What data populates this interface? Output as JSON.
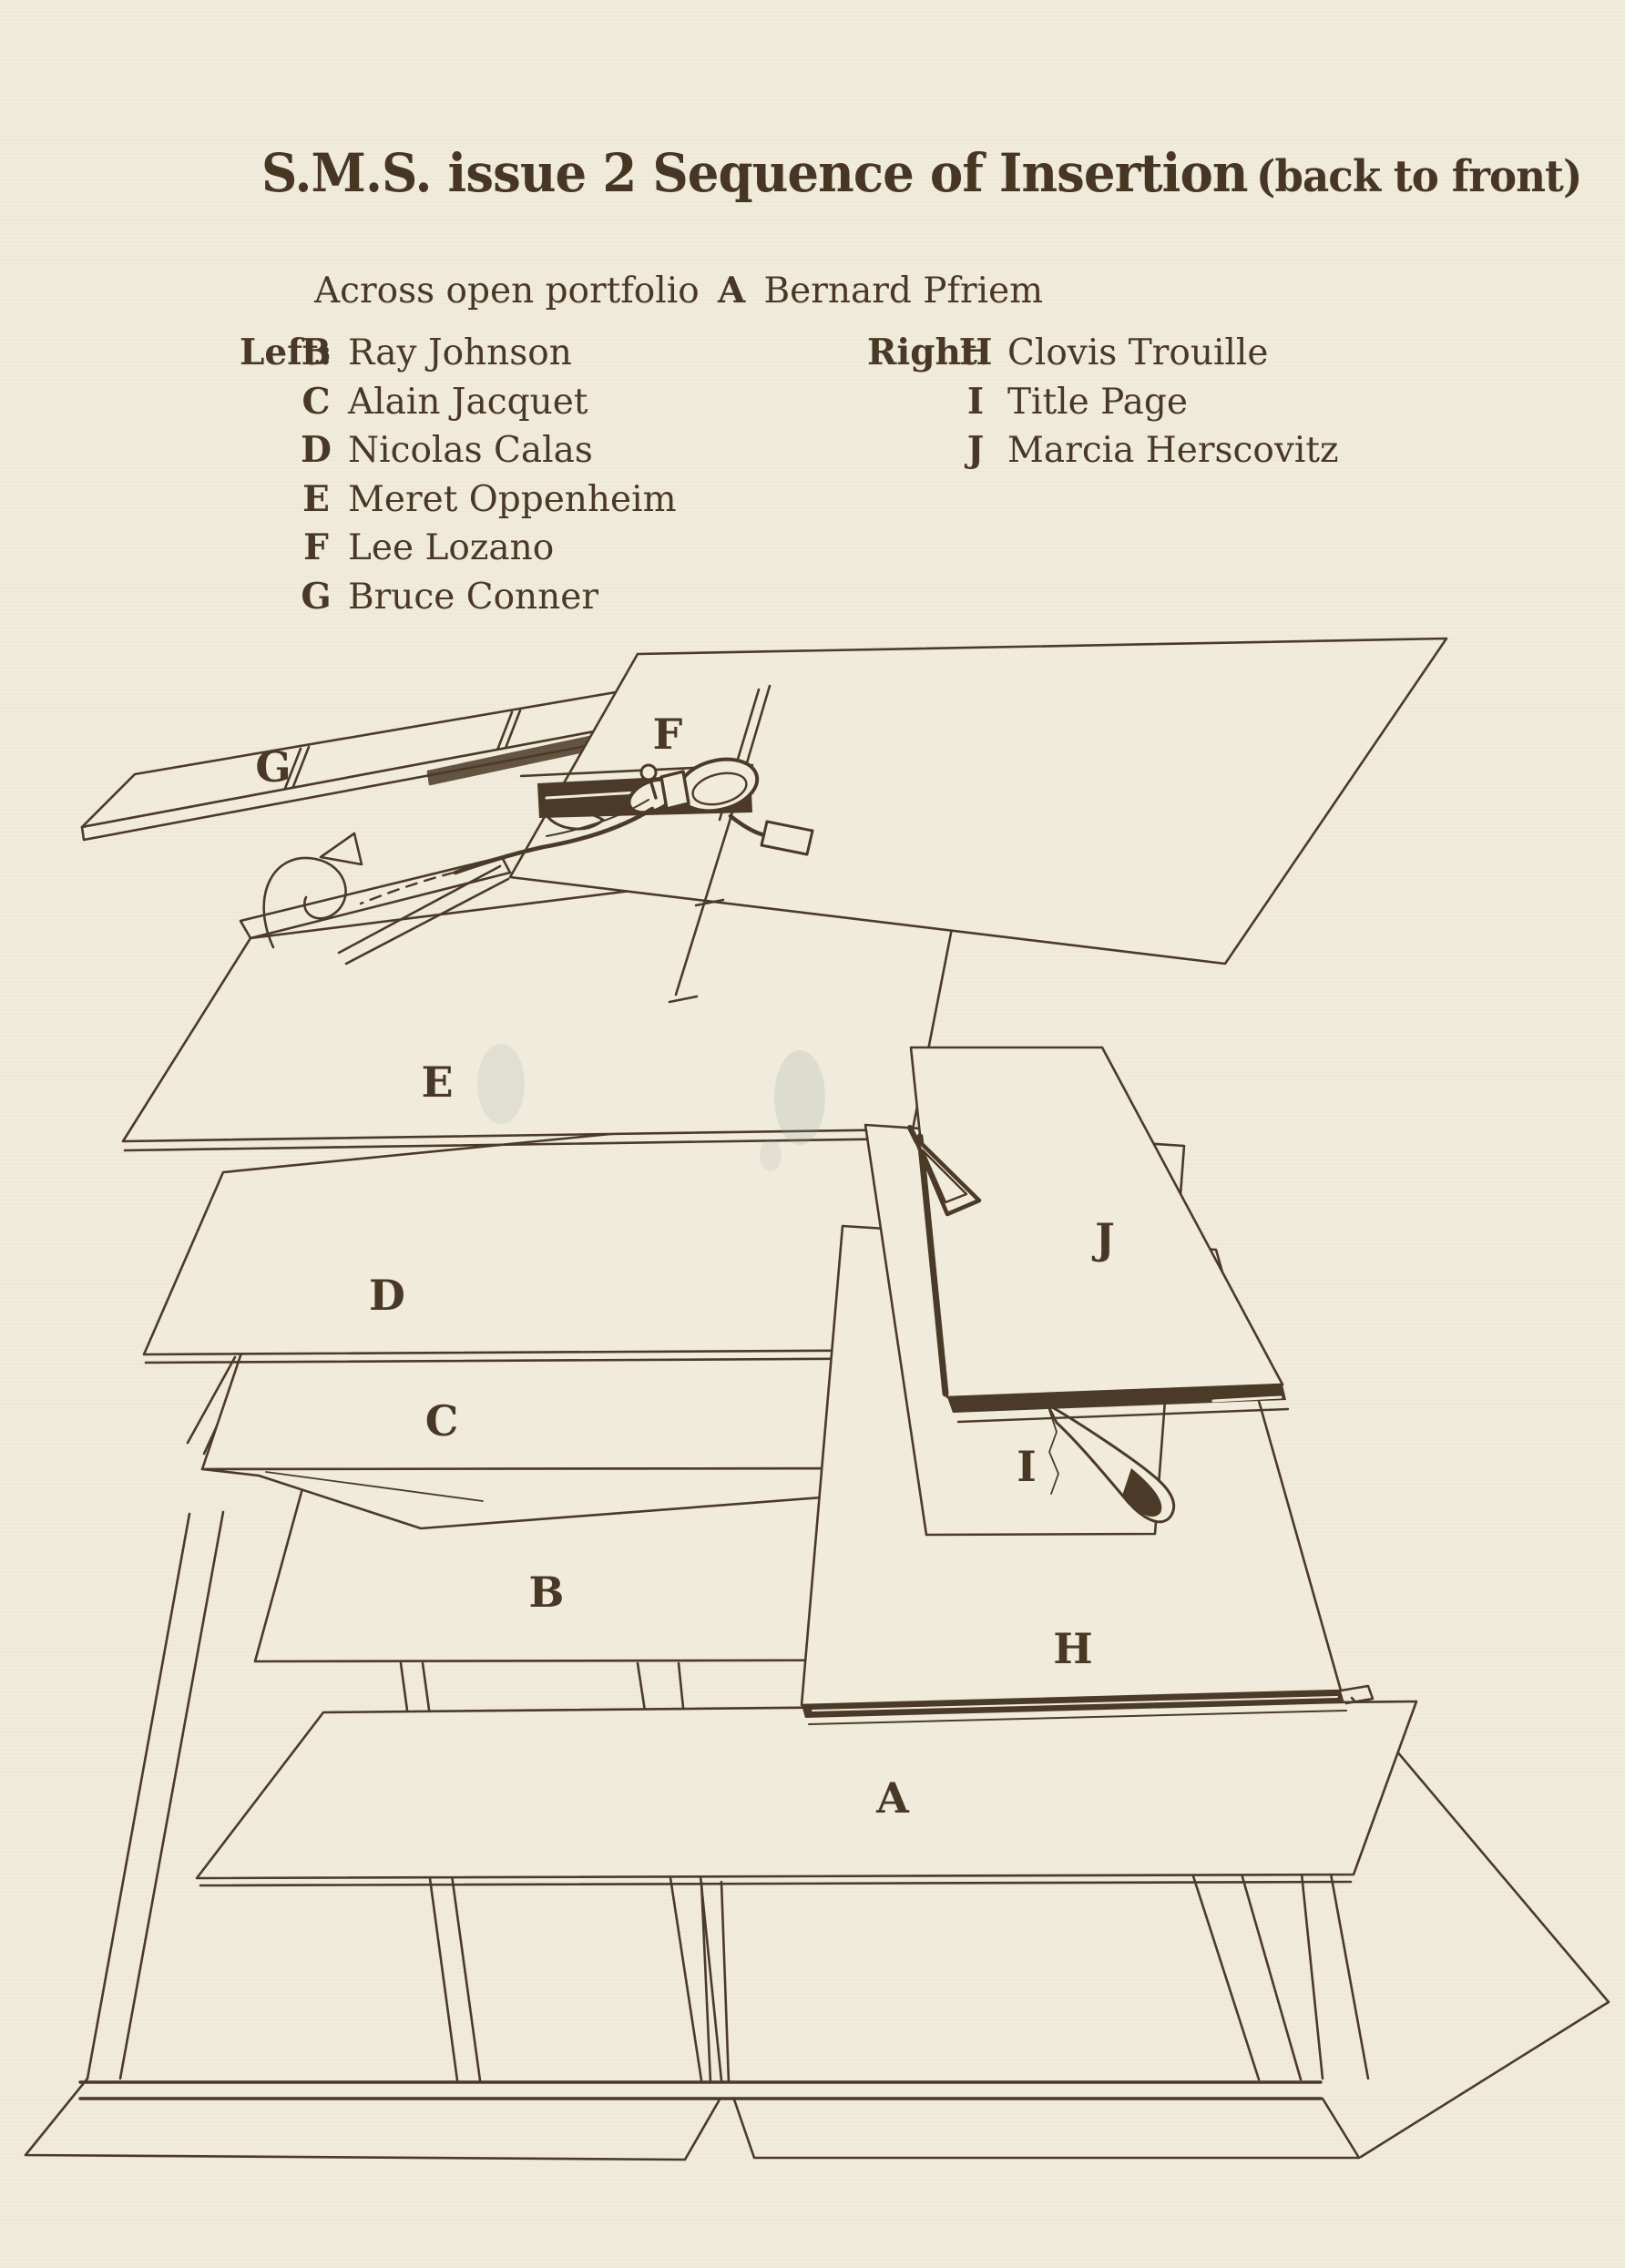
{
  "colors": {
    "background": "#f1ebdb",
    "ink": "#4b3a27",
    "text": "#473624"
  },
  "header": {
    "title": "S.M.S. issue 2 Sequence of Insertion",
    "subtitle": "(back to front)"
  },
  "legend": {
    "across": {
      "label": "Across open portfolio",
      "letter": "A",
      "name": "Bernard Pfriem"
    },
    "left": {
      "heading": "Left:",
      "items": [
        {
          "letter": "B",
          "name": "Ray Johnson"
        },
        {
          "letter": "C",
          "name": "Alain Jacquet"
        },
        {
          "letter": "D",
          "name": "Nicolas Calas"
        },
        {
          "letter": "E",
          "name": "Meret Oppenheim"
        },
        {
          "letter": "F",
          "name": "Lee Lozano"
        },
        {
          "letter": "G",
          "name": "Bruce Conner"
        }
      ]
    },
    "right": {
      "heading": "Right:",
      "items": [
        {
          "letter": "H",
          "name": "Clovis Trouille"
        },
        {
          "letter": "I",
          "name": "Title Page"
        },
        {
          "letter": "J",
          "name": "Marcia Herscovitz"
        }
      ]
    }
  },
  "diagram": {
    "labels": {
      "A": "A",
      "B": "B",
      "C": "C",
      "D": "D",
      "E": "E",
      "F": "F",
      "G": "G",
      "H": "H",
      "I": "I",
      "J": "J"
    }
  }
}
